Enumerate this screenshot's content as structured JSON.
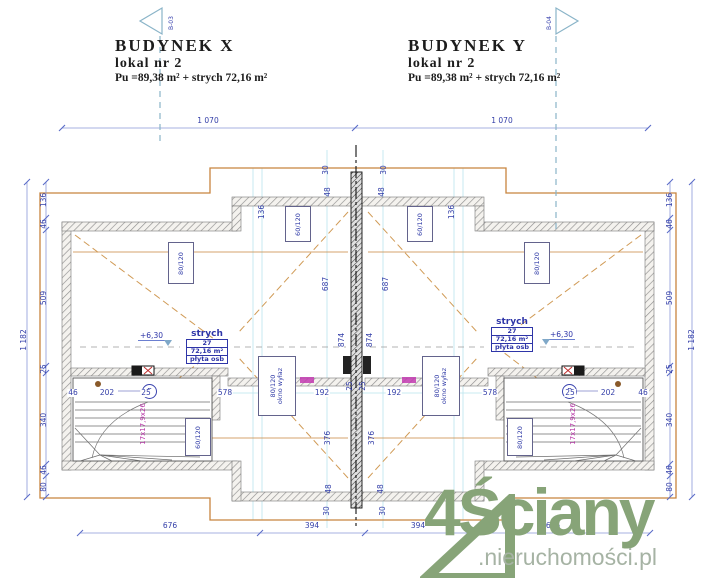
{
  "header": {
    "left": {
      "title": "BUDYNEK  X",
      "unit": "lokal  nr 2",
      "area": "Pu =89,38 m²  +  strych  72,16 m²"
    },
    "right": {
      "title": "BUDYNEK  Y",
      "unit": "lokal  nr 2",
      "area": "Pu =89,38 m²  +  strych  72,16 m²"
    }
  },
  "section_markers": {
    "left": "B-03",
    "right": "B-04"
  },
  "rooms": {
    "left": {
      "name": "strych",
      "number": "27",
      "area": "72,16 m²",
      "floor": "płyta osb",
      "level": "+6,30"
    },
    "right": {
      "name": "strych",
      "number": "27",
      "area": "72,16 m²",
      "floor": "płyta osb",
      "level": "+6,30"
    }
  },
  "stairs": {
    "label": "17x17,9x26",
    "direction_symbol": "P"
  },
  "watermark": {
    "brand": "4Ściany",
    "domain": ".nieruchomości.pl"
  },
  "colors": {
    "dimension_blue": "#333ea8",
    "roof_orange": "#c8843e",
    "construction_cyan": "#b9e4ee",
    "magenta": "#b837a8",
    "logo_green": "#87a478",
    "logo_gray": "#a6b3a4"
  },
  "dimensions": [
    {
      "t": "1 070",
      "x": 208,
      "y": 121,
      "r": 0
    },
    {
      "t": "1 070",
      "x": 502,
      "y": 121,
      "r": 0
    },
    {
      "t": "676",
      "x": 170,
      "y": 526,
      "r": 0
    },
    {
      "t": "394",
      "x": 312,
      "y": 526,
      "r": 0
    },
    {
      "t": "394",
      "x": 418,
      "y": 526,
      "r": 0
    },
    {
      "t": "676",
      "x": 553,
      "y": 526,
      "r": 0
    },
    {
      "t": "1 182",
      "x": 24,
      "y": 340,
      "r": -90
    },
    {
      "t": "136",
      "x": 44,
      "y": 200,
      "r": -90
    },
    {
      "t": "46",
      "x": 44,
      "y": 224,
      "r": -90
    },
    {
      "t": "509",
      "x": 44,
      "y": 298,
      "r": -90
    },
    {
      "t": "25",
      "x": 44,
      "y": 369,
      "r": -90
    },
    {
      "t": "340",
      "x": 44,
      "y": 420,
      "r": -90
    },
    {
      "t": "46",
      "x": 44,
      "y": 470,
      "r": -90
    },
    {
      "t": "80",
      "x": 44,
      "y": 487,
      "r": -90
    },
    {
      "t": "136",
      "x": 670,
      "y": 200,
      "r": -90
    },
    {
      "t": "46",
      "x": 670,
      "y": 224,
      "r": -90
    },
    {
      "t": "509",
      "x": 670,
      "y": 298,
      "r": -90
    },
    {
      "t": "25",
      "x": 670,
      "y": 369,
      "r": -90
    },
    {
      "t": "340",
      "x": 670,
      "y": 420,
      "r": -90
    },
    {
      "t": "46",
      "x": 670,
      "y": 470,
      "r": -90
    },
    {
      "t": "80",
      "x": 670,
      "y": 487,
      "r": -90
    },
    {
      "t": "1 182",
      "x": 692,
      "y": 340,
      "r": -90
    },
    {
      "t": "30",
      "x": 326,
      "y": 170,
      "r": -90
    },
    {
      "t": "30",
      "x": 384,
      "y": 170,
      "r": -90
    },
    {
      "t": "48",
      "x": 328,
      "y": 192,
      "r": -90
    },
    {
      "t": "48",
      "x": 382,
      "y": 192,
      "r": -90
    },
    {
      "t": "687",
      "x": 326,
      "y": 284,
      "r": -90
    },
    {
      "t": "687",
      "x": 386,
      "y": 284,
      "r": -90
    },
    {
      "t": "874",
      "x": 342,
      "y": 340,
      "r": -90
    },
    {
      "t": "874",
      "x": 370,
      "y": 340,
      "r": -90
    },
    {
      "t": "376",
      "x": 328,
      "y": 438,
      "r": -90
    },
    {
      "t": "376",
      "x": 372,
      "y": 438,
      "r": -90
    },
    {
      "t": "48",
      "x": 329,
      "y": 489,
      "r": -90
    },
    {
      "t": "48",
      "x": 381,
      "y": 489,
      "r": -90
    },
    {
      "t": "30",
      "x": 327,
      "y": 511,
      "r": -90
    },
    {
      "t": "30",
      "x": 383,
      "y": 511,
      "r": -90
    },
    {
      "t": "136",
      "x": 262,
      "y": 212,
      "r": -90
    },
    {
      "t": "136",
      "x": 452,
      "y": 212,
      "r": -90
    },
    {
      "t": "46",
      "x": 73,
      "y": 393,
      "r": 0
    },
    {
      "t": "202",
      "x": 107,
      "y": 393,
      "r": 0
    },
    {
      "t": "25",
      "x": 146,
      "y": 393,
      "r": 0
    },
    {
      "t": "578",
      "x": 225,
      "y": 393,
      "r": 0
    },
    {
      "t": "192",
      "x": 322,
      "y": 393,
      "r": 0
    },
    {
      "t": "25",
      "x": 350,
      "y": 386,
      "r": -90
    },
    {
      "t": "25",
      "x": 363,
      "y": 386,
      "r": -90
    },
    {
      "t": "192",
      "x": 394,
      "y": 393,
      "r": 0
    },
    {
      "t": "578",
      "x": 490,
      "y": 393,
      "r": 0
    },
    {
      "t": "25",
      "x": 570,
      "y": 393,
      "r": 0
    },
    {
      "t": "202",
      "x": 608,
      "y": 393,
      "r": 0
    },
    {
      "t": "46",
      "x": 643,
      "y": 393,
      "r": 0
    }
  ],
  "window_labels": [
    {
      "t": "80/120",
      "sub": "",
      "x": 168,
      "y": 242,
      "w": 24,
      "h": 40
    },
    {
      "t": "60/120",
      "sub": "",
      "x": 285,
      "y": 206,
      "w": 24,
      "h": 34
    },
    {
      "t": "60/120",
      "sub": "",
      "x": 185,
      "y": 418,
      "w": 24,
      "h": 36
    },
    {
      "t": "80/120",
      "sub": "okno wyłaz",
      "x": 258,
      "y": 356,
      "w": 36,
      "h": 58
    },
    {
      "t": "60/120",
      "sub": "",
      "x": 407,
      "y": 206,
      "w": 24,
      "h": 34
    },
    {
      "t": "80/120",
      "sub": "",
      "x": 524,
      "y": 242,
      "w": 24,
      "h": 40
    },
    {
      "t": "80/120",
      "sub": "",
      "x": 507,
      "y": 418,
      "w": 24,
      "h": 36
    },
    {
      "t": "80/120",
      "sub": "okno wyłaz",
      "x": 422,
      "y": 356,
      "w": 36,
      "h": 58
    }
  ]
}
